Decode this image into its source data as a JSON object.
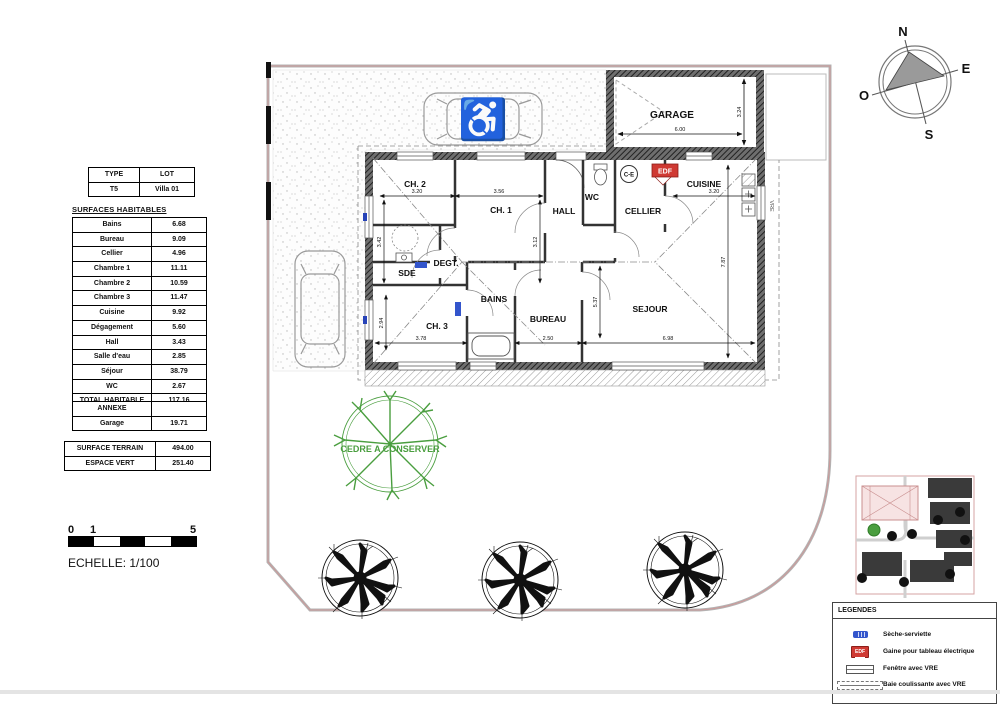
{
  "info_table": {
    "headers": [
      "TYPE",
      "LOT"
    ],
    "values": [
      "T5",
      "Villa 01"
    ]
  },
  "surfaces": {
    "title": "SURFACES HABITABLES",
    "rows": [
      {
        "label": "Bains",
        "value": "6.68"
      },
      {
        "label": "Bureau",
        "value": "9.09"
      },
      {
        "label": "Cellier",
        "value": "4.96"
      },
      {
        "label": "Chambre 1",
        "value": "11.11"
      },
      {
        "label": "Chambre 2",
        "value": "10.59"
      },
      {
        "label": "Chambre 3",
        "value": "11.47"
      },
      {
        "label": "Cuisine",
        "value": "9.92"
      },
      {
        "label": "Dégagement",
        "value": "5.60"
      },
      {
        "label": "Hall",
        "value": "3.43"
      },
      {
        "label": "Salle d'eau",
        "value": "2.85"
      },
      {
        "label": "Séjour",
        "value": "38.79"
      },
      {
        "label": "WC",
        "value": "2.67"
      }
    ],
    "total": {
      "label": "TOTAL HABITABLE",
      "value": "117.16"
    }
  },
  "annexe": {
    "header": "ANNEXE",
    "row": {
      "label": "Garage",
      "value": "19.71"
    }
  },
  "terrain": {
    "rows": [
      {
        "label": "SURFACE TERRAIN",
        "value": "494.00"
      },
      {
        "label": "ESPACE VERT",
        "value": "251.40"
      }
    ]
  },
  "scale": {
    "tick0": "0",
    "tick1": "1",
    "tick5": "5",
    "caption": "ECHELLE: 1/100"
  },
  "compass": {
    "n": "N",
    "e": "E",
    "s": "S",
    "o": "O"
  },
  "plan": {
    "rooms": {
      "ch2": "CH. 2",
      "ch1": "CH. 1",
      "hall": "HALL",
      "wc": "WC",
      "cellier": "CELLIER",
      "cuisine": "CUISINE",
      "sde": "SDE",
      "degt": "DEGT.",
      "bains": "BAINS",
      "ch3": "CH. 3",
      "bureau": "BUREAU",
      "sejour": "SEJOUR",
      "garage": "GARAGE"
    },
    "dims": {
      "ch2_w": "3.20",
      "ch2_h": "3.42",
      "ch1_w": "3.56",
      "ch1_h": "3.12",
      "cuisine_w": "3.20",
      "ch3_w": "3.78",
      "ch3_h": "2.94",
      "bureau_w": "2.50",
      "sejour_w": "6.98",
      "sejour_h": "5.37",
      "right_h": "7.87",
      "garage_w": "6.00",
      "garage_h": "3.24"
    },
    "badges": {
      "edf": "EDF",
      "ce": "C-E",
      "vre": "VRE"
    },
    "cedar_label": "CEDRE A CONSERVER"
  },
  "legend": {
    "title": "LEGENDES",
    "items": [
      {
        "icon": "seche-serviette-icon",
        "label": "Sèche-serviette"
      },
      {
        "icon": "edf-icon",
        "label": "Gaine pour tableau électrique"
      },
      {
        "icon": "fenetre-icon",
        "label": "Fenêtre avec VRE"
      },
      {
        "icon": "baie-icon",
        "label": "Baie coulissante avec VRE"
      }
    ]
  },
  "colors": {
    "accent_blue": "#2743b8",
    "accent_red": "#cf3a33",
    "accent_green": "#4a9e3f",
    "boundary_pink": "#c99",
    "wall_dark": "#3c3c3c"
  }
}
